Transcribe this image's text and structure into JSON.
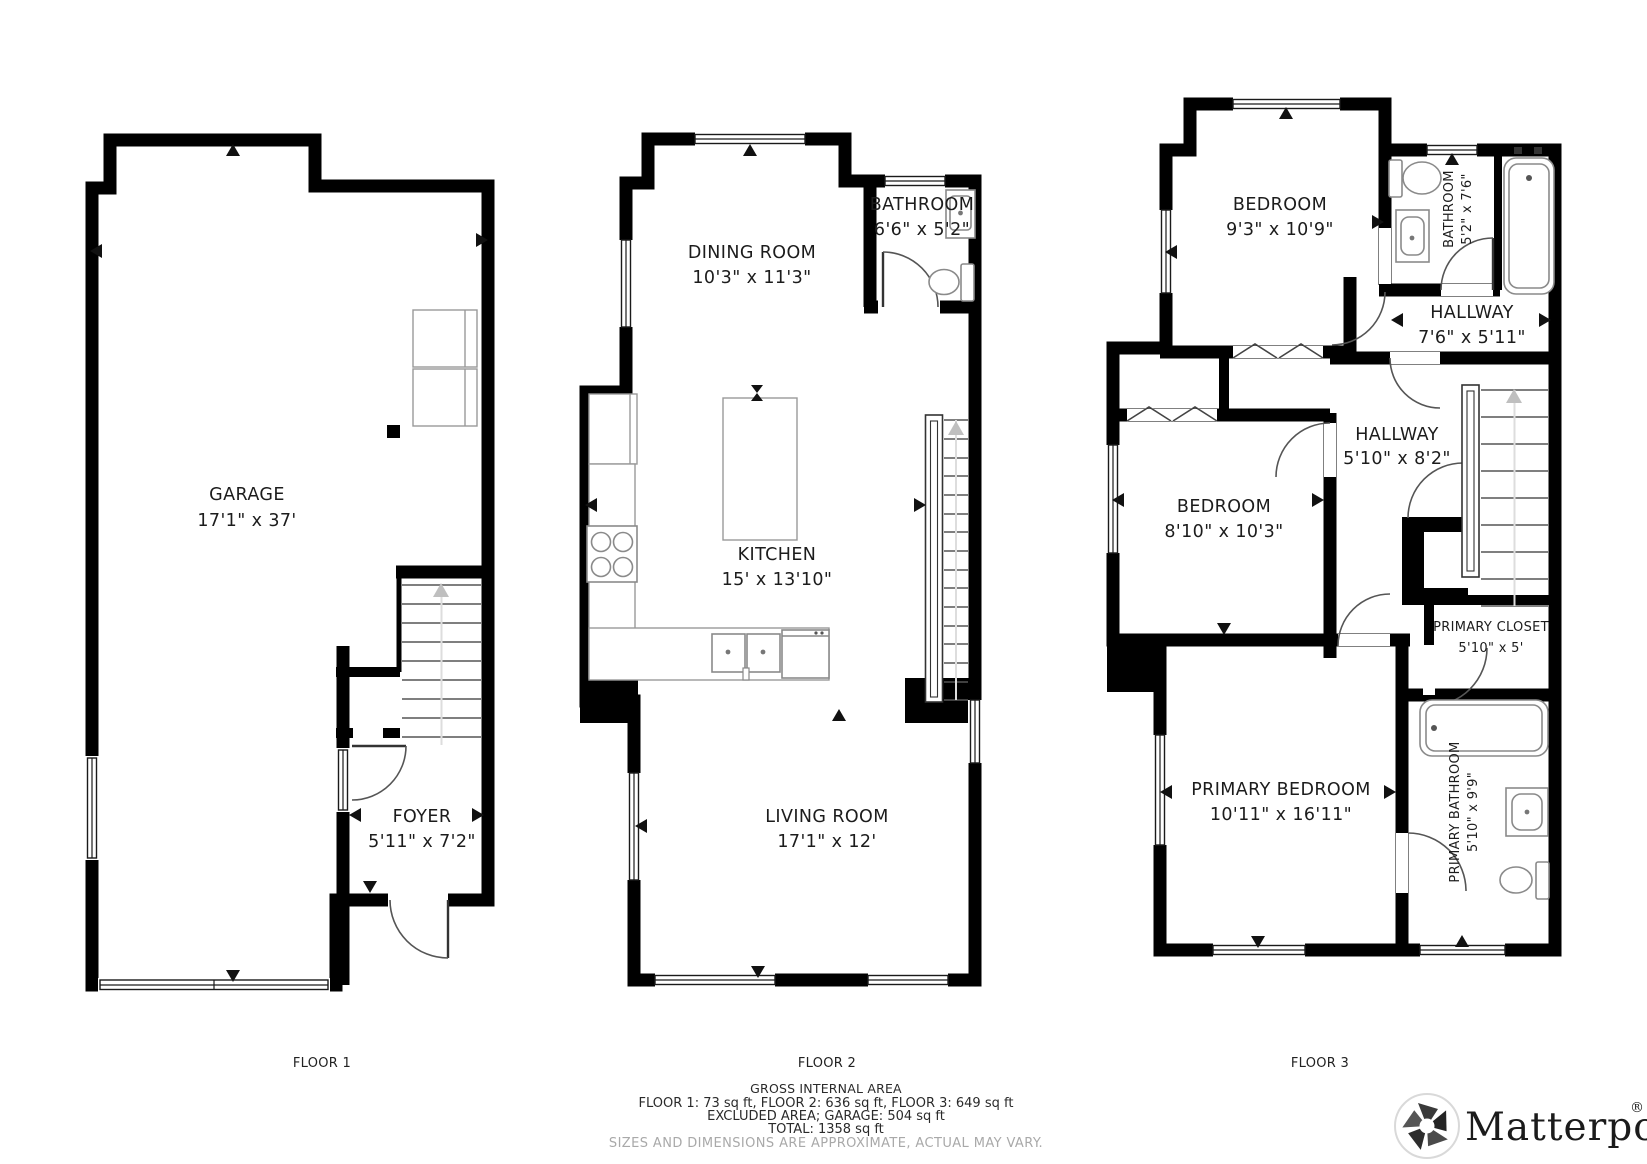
{
  "rooms": {
    "garage": {
      "name": "GARAGE",
      "dims": "17'1\" x 37'"
    },
    "foyer": {
      "name": "FOYER",
      "dims": "5'11\" x 7'2\""
    },
    "dining": {
      "name": "DINING ROOM",
      "dims": "10'3\" x 11'3\""
    },
    "bathroom2": {
      "name": "BATHROOM",
      "dims": "6'6\" x 5'2\""
    },
    "kitchen": {
      "name": "KITCHEN",
      "dims": "15' x 13'10\""
    },
    "living": {
      "name": "LIVING ROOM",
      "dims": "17'1\" x 12'"
    },
    "bedroom1": {
      "name": "BEDROOM",
      "dims": "9'3\" x 10'9\""
    },
    "bathroom3": {
      "name": "BATHROOM",
      "dims": "5'2\" x 7'6\""
    },
    "hallway1": {
      "name": "HALLWAY",
      "dims": "7'6\" x 5'11\""
    },
    "hallway2": {
      "name": "HALLWAY",
      "dims": "5'10\" x 8'2\""
    },
    "bedroom2": {
      "name": "BEDROOM",
      "dims": "8'10\" x 10'3\""
    },
    "primary_closet": {
      "name": "PRIMARY CLOSET",
      "dims": "5'10\" x 5'"
    },
    "primary_bedroom": {
      "name": "PRIMARY BEDROOM",
      "dims": "10'11\" x 16'11\""
    },
    "primary_bathroom": {
      "name": "PRIMARY BATHROOM",
      "dims": "5'10\" x 9'9\""
    }
  },
  "floors": {
    "floor1": "FLOOR 1",
    "floor2": "FLOOR 2",
    "floor3": "FLOOR 3"
  },
  "summary": {
    "title": "GROSS INTERNAL AREA",
    "line1": "FLOOR 1: 73 sq ft, FLOOR 2: 636 sq ft, FLOOR 3: 649 sq ft",
    "line2": "EXCLUDED AREA; GARAGE: 504 sq ft",
    "line3": "TOTAL: 1358 sq ft",
    "disclaimer": "SIZES AND DIMENSIONS ARE APPROXIMATE, ACTUAL MAY VARY."
  },
  "branding": {
    "logo_text": "Matterport",
    "registered": "®"
  },
  "colors": {
    "wall": "#000000",
    "fixture_outline": "#8a8a8a",
    "stair_tread": "#555555",
    "arrow_gray": "#bfbfbf",
    "disclaimer_gray": "#a9a9a9",
    "logo_text": "#1b1b1b",
    "background": "#ffffff"
  }
}
